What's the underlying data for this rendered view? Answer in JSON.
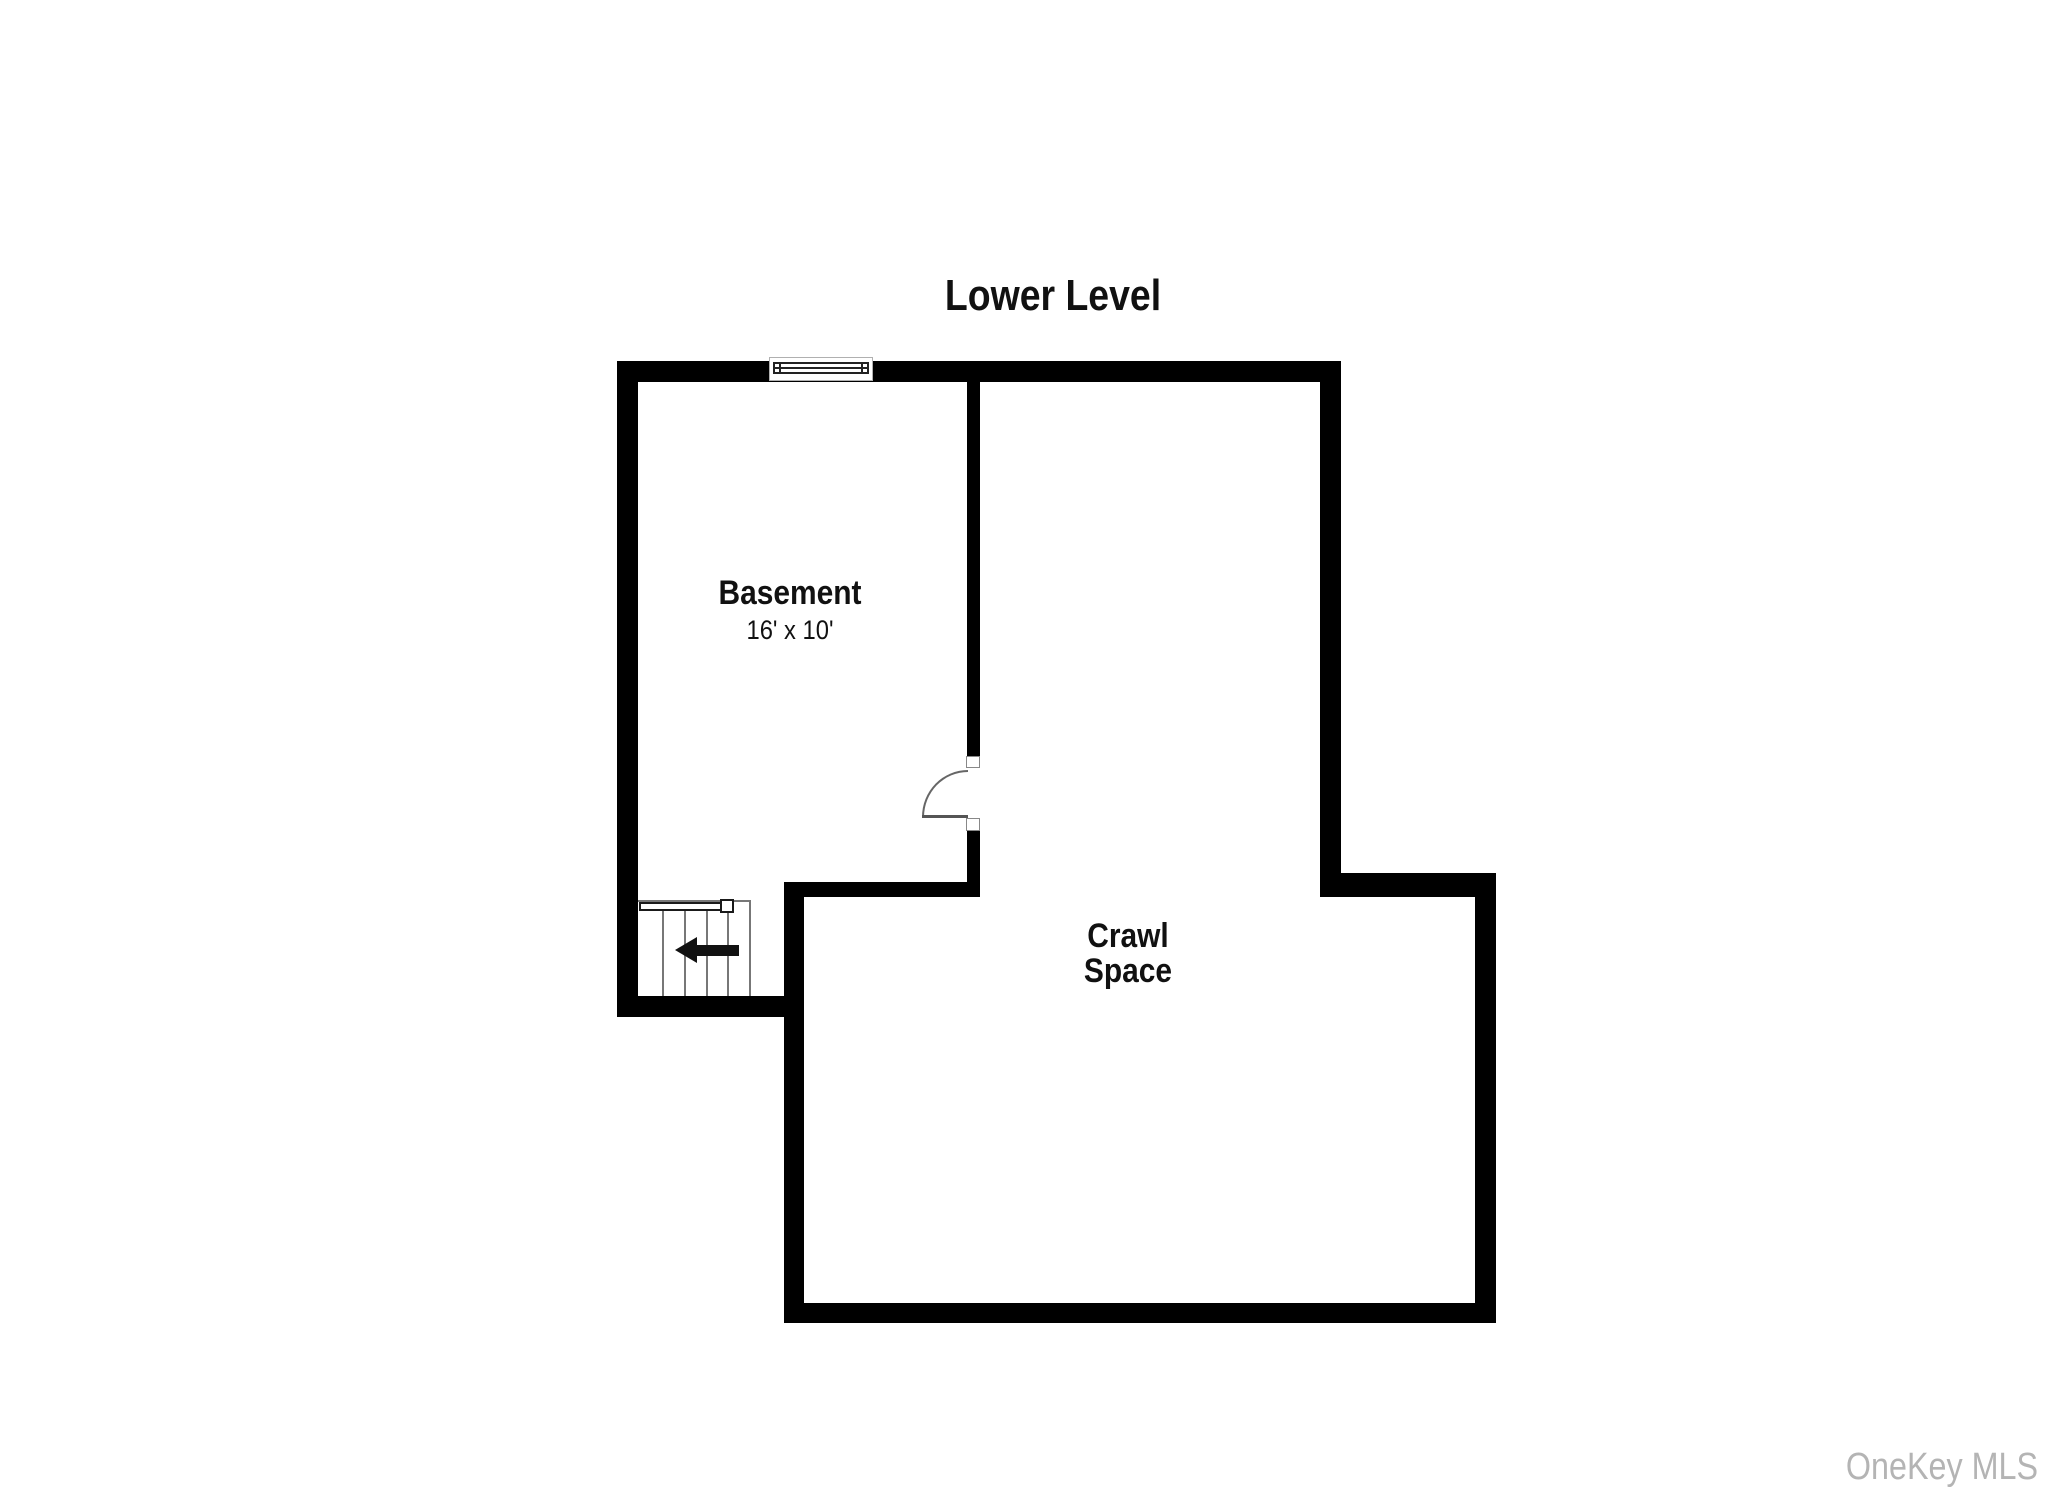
{
  "title": "Lower Level",
  "rooms": {
    "basement": {
      "name": "Basement",
      "dimensions": "16' x 10'"
    },
    "crawl_space": {
      "name": "Crawl Space"
    }
  },
  "watermark": "OneKey MLS",
  "symbols": {
    "window": "window-symbol",
    "door": "door-swing-symbol",
    "stairs": "staircase-symbol",
    "stairs_direction": "direction-arrow-left"
  },
  "colors": {
    "wall": "#000000",
    "label": "#111111",
    "line": "#777777",
    "watermark": "#b4b4b4"
  }
}
